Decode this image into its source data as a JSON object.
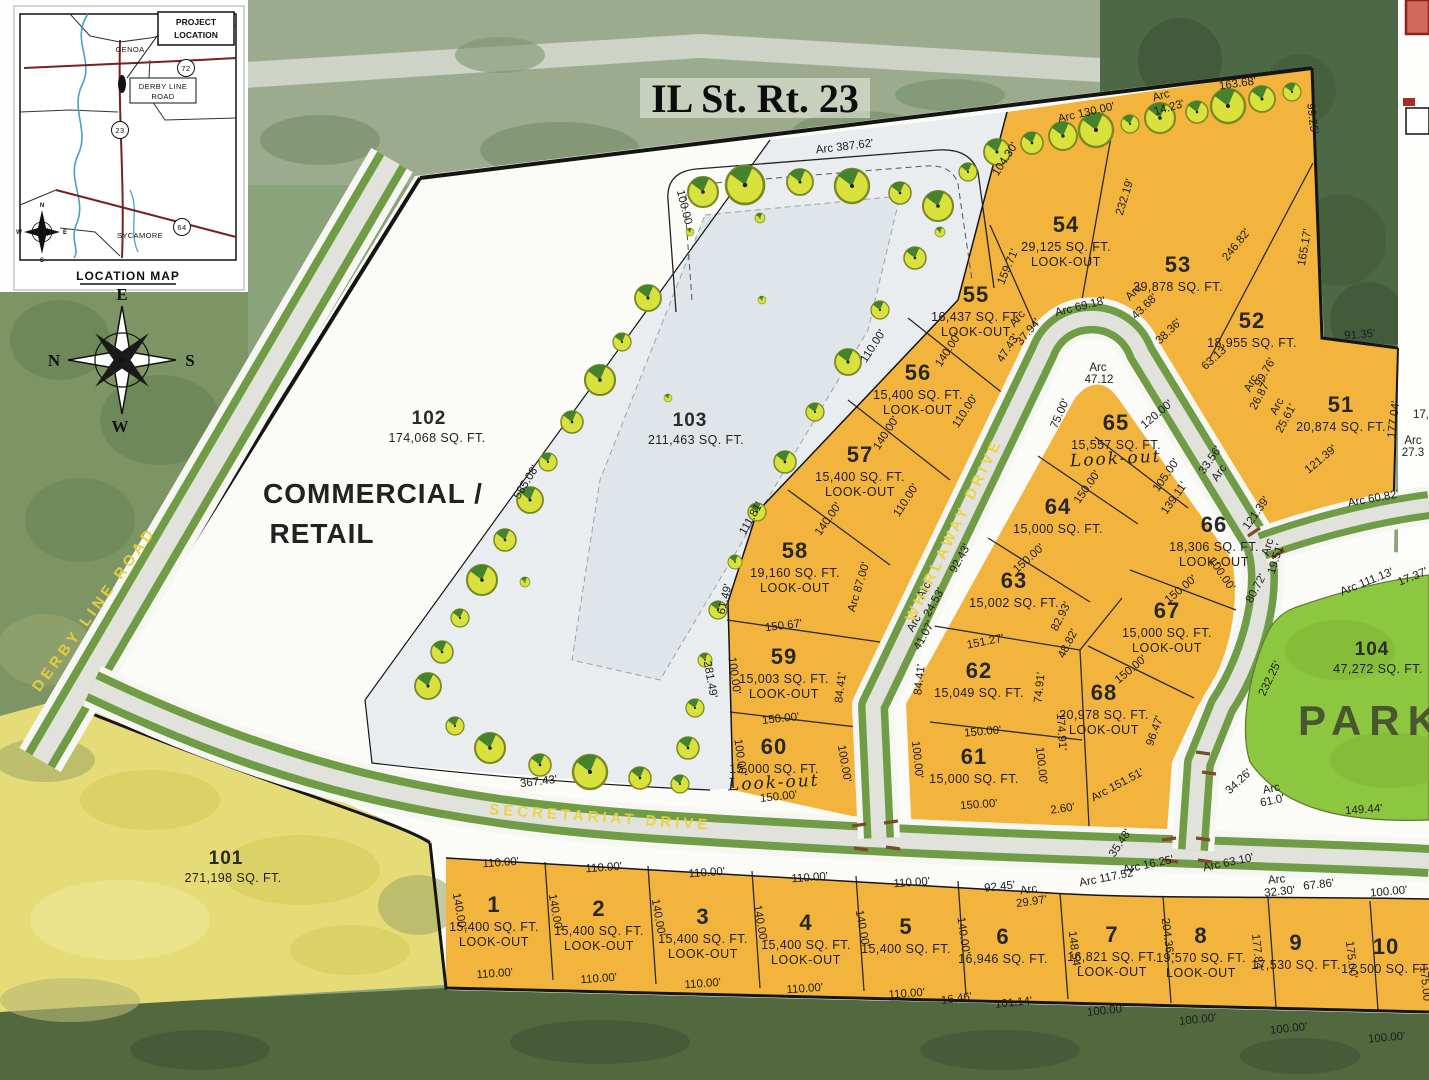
{
  "title": "IL St. Rt. 23",
  "location_map": {
    "caption": "LOCATION MAP",
    "project_location_line1": "PROJECT",
    "project_location_line2": "LOCATION",
    "town_north": "GENOA",
    "town_south": "SYCAMORE",
    "road_box_line1": "DERBY LINE",
    "road_box_line2": "ROAD",
    "route_72": "72",
    "route_23": "23",
    "route_64": "64",
    "compass": {
      "n": "N",
      "e": "E",
      "s": "S",
      "w": "W"
    }
  },
  "compass_rose": {
    "n": "N",
    "e": "E",
    "s": "S",
    "w": "W"
  },
  "roads": {
    "derby_line": "DERBY LINE ROAD",
    "secretariat": "SECRETARIAT DRIVE",
    "whirlaway": "WHIRLAWAY DRIVE"
  },
  "areas": {
    "commercial": {
      "num": "102",
      "sqft": "174,068 SQ. FT.",
      "line1": "COMMERCIAL /",
      "line2": "RETAIL"
    },
    "outlot103": {
      "num": "103",
      "sqft": "211,463 SQ. FT."
    },
    "outlot101": {
      "num": "101",
      "sqft": "271,198 SQ. FT."
    },
    "park": {
      "num": "104",
      "sqft": "47,272 SQ. FT.",
      "label": "PARK"
    }
  },
  "colors": {
    "lot_orange": "#F3B43E",
    "park_green": "#8DC63F",
    "field_yellow": "#E6DC77",
    "road_verge": "#6F9C45",
    "road_pavement": "#E2E2DC",
    "street_label_yellow": "#E9D33C"
  },
  "lots": [
    {
      "n": "54",
      "s": "29,125 SQ. FT.",
      "lo": "LOOK-OUT",
      "x": 1066,
      "y": 232
    },
    {
      "n": "53",
      "s": "39,878 SQ. FT.",
      "x": 1178,
      "y": 272
    },
    {
      "n": "52",
      "s": "18,955 SQ. FT.",
      "x": 1252,
      "y": 328
    },
    {
      "n": "55",
      "s": "16,437 SQ. FT.",
      "lo": "LOOK-OUT",
      "x": 976,
      "y": 302
    },
    {
      "n": "51",
      "s": "20,874 SQ. FT.",
      "x": 1341,
      "y": 412
    },
    {
      "n": "56",
      "s": "15,400 SQ. FT.",
      "lo": "LOOK-OUT",
      "x": 918,
      "y": 380
    },
    {
      "n": "57",
      "s": "15,400 SQ. FT.",
      "lo": "LOOK-OUT",
      "x": 860,
      "y": 462
    },
    {
      "n": "65",
      "s": "15,557 SQ. FT.",
      "lo": "Look-out",
      "hand": true,
      "x": 1116,
      "y": 430
    },
    {
      "n": "64",
      "s": "15,000 SQ. FT.",
      "x": 1058,
      "y": 514
    },
    {
      "n": "66",
      "s": "18,306 SQ. FT.",
      "lo": "LOOK-OUT",
      "x": 1214,
      "y": 532
    },
    {
      "n": "58",
      "s": "19,160 SQ. FT.",
      "lo": "LOOK-OUT",
      "x": 795,
      "y": 558
    },
    {
      "n": "63",
      "s": "15,002 SQ. FT.",
      "x": 1014,
      "y": 588
    },
    {
      "n": "67",
      "s": "15,000 SQ. FT.",
      "lo": "LOOK-OUT",
      "x": 1167,
      "y": 618
    },
    {
      "n": "59",
      "s": "15,003 SQ. FT.",
      "lo": "LOOK-OUT",
      "x": 784,
      "y": 664
    },
    {
      "n": "62",
      "s": "15,049 SQ. FT.",
      "x": 979,
      "y": 678
    },
    {
      "n": "68",
      "s": "20,978 SQ. FT.",
      "lo": "LOOK-OUT",
      "x": 1104,
      "y": 700
    },
    {
      "n": "60",
      "s": "15,000 SQ. FT.",
      "lo": "Look-out",
      "hand": true,
      "x": 774,
      "y": 754
    },
    {
      "n": "61",
      "s": "15,000 SQ. FT.",
      "x": 974,
      "y": 764
    },
    {
      "n": "1",
      "s": "15,400 SQ. FT.",
      "lo": "LOOK-OUT",
      "x": 494,
      "y": 912
    },
    {
      "n": "2",
      "s": "15,400 SQ. FT.",
      "lo": "LOOK-OUT",
      "x": 599,
      "y": 916
    },
    {
      "n": "3",
      "s": "15,400 SQ. FT.",
      "lo": "LOOK-OUT",
      "x": 703,
      "y": 924
    },
    {
      "n": "4",
      "s": "15,400 SQ. FT.",
      "lo": "LOOK-OUT",
      "x": 806,
      "y": 930
    },
    {
      "n": "5",
      "s": "15,400 SQ. FT.",
      "x": 906,
      "y": 934
    },
    {
      "n": "6",
      "s": "16,946 SQ. FT.",
      "x": 1003,
      "y": 944
    },
    {
      "n": "7",
      "s": "16,821 SQ. FT.",
      "lo": "LOOK-OUT",
      "x": 1112,
      "y": 942
    },
    {
      "n": "8",
      "s": "19,570 SQ. FT.",
      "lo": "LOOK-OUT",
      "x": 1201,
      "y": 943
    },
    {
      "n": "9",
      "s": "17,530 SQ. FT.",
      "x": 1296,
      "y": 950
    },
    {
      "n": "10",
      "s": "17,500 SQ. FT.",
      "x": 1386,
      "y": 954
    }
  ],
  "dimensions": [
    [
      "Arc 387.62'",
      845,
      150,
      -7
    ],
    [
      "100.00",
      681,
      208,
      76
    ],
    [
      "Arc 130.00'",
      1087,
      116,
      -13
    ],
    [
      "163.68'",
      1238,
      87,
      -8
    ],
    [
      "Arc",
      1162,
      99,
      -16
    ],
    [
      "14.23'",
      1170,
      111,
      -16
    ],
    [
      "99.25'",
      1309,
      119,
      83
    ],
    [
      "104.30'",
      1008,
      161,
      -57
    ],
    [
      "232.19'",
      1128,
      198,
      -73
    ],
    [
      "246.82'",
      1239,
      247,
      -51
    ],
    [
      "165.17'",
      1308,
      248,
      -80
    ],
    [
      "159.71'",
      1011,
      268,
      -67
    ],
    [
      "91.35'",
      1360,
      338,
      -4
    ],
    [
      "Arc 69.18'",
      1081,
      310,
      -14
    ],
    [
      "Arc",
      1136,
      295,
      -44
    ],
    [
      "43.68'",
      1147,
      309,
      -44
    ],
    [
      "38.36'",
      1171,
      334,
      -44
    ],
    [
      "Arc",
      1020,
      321,
      -50
    ],
    [
      "37.94'",
      1031,
      334,
      -50
    ],
    [
      "47.43'",
      1011,
      350,
      -57
    ],
    [
      "63.13'",
      1217,
      360,
      -42
    ],
    [
      "99.76'",
      1268,
      374,
      -60
    ],
    [
      "177.04'",
      1397,
      420,
      -83
    ],
    [
      "121.39'",
      1323,
      462,
      -40
    ],
    [
      "Arc 60.82'",
      1374,
      502,
      -10
    ],
    [
      "17,",
      1421,
      418,
      0
    ],
    [
      "Arc",
      1413,
      444,
      0
    ],
    [
      "27.3",
      1413,
      456,
      0
    ],
    [
      "Arc",
      1098,
      371,
      0
    ],
    [
      "47.12",
      1099,
      383,
      0
    ],
    [
      "120.00'",
      1159,
      417,
      -40
    ],
    [
      "75.00'",
      1063,
      415,
      -66
    ],
    [
      "150.00'",
      1090,
      489,
      -55
    ],
    [
      "105.00'",
      1169,
      477,
      -55
    ],
    [
      "139.11'",
      1177,
      500,
      -55
    ],
    [
      "33.56'",
      1213,
      462,
      -55
    ],
    [
      "Arc",
      1222,
      475,
      -55
    ],
    [
      "121.39'",
      1259,
      515,
      -55
    ],
    [
      "Arc",
      1254,
      385,
      -62
    ],
    [
      "26.87'",
      1263,
      397,
      -62
    ],
    [
      "Arc",
      1280,
      408,
      -62
    ],
    [
      "25.61'",
      1289,
      420,
      -62
    ],
    [
      "Arc",
      1271,
      548,
      -72
    ],
    [
      "19.51'",
      1279,
      560,
      -72
    ],
    [
      "80.72'",
      1259,
      590,
      -62
    ],
    [
      "96.47'",
      1158,
      732,
      -70
    ],
    [
      "150.00'",
      1183,
      592,
      -40
    ],
    [
      "100.00'",
      1219,
      576,
      55
    ],
    [
      "150.00'",
      1133,
      672,
      -40
    ],
    [
      "110.00'",
      876,
      348,
      -57
    ],
    [
      "140.00'",
      951,
      352,
      -57
    ],
    [
      "110.00'",
      968,
      413,
      -57
    ],
    [
      "140.00'",
      889,
      435,
      -57
    ],
    [
      "110.00'",
      909,
      502,
      -57
    ],
    [
      "140.00'",
      831,
      521,
      -55
    ],
    [
      "Arc 87.00'",
      862,
      588,
      -73
    ],
    [
      "111.81'",
      754,
      520,
      -60
    ],
    [
      "61.49'",
      728,
      600,
      -76
    ],
    [
      "150.67'",
      784,
      629,
      -7
    ],
    [
      "84.41'",
      844,
      688,
      -83
    ],
    [
      "100.00'",
      731,
      676,
      82
    ],
    [
      "150.00'",
      781,
      722,
      -6
    ],
    [
      "100.00'",
      737,
      758,
      82
    ],
    [
      "100.00'",
      841,
      764,
      80
    ],
    [
      "150.00'",
      779,
      800,
      -6
    ],
    [
      "281.49'",
      707,
      680,
      80
    ],
    [
      "585.08'",
      529,
      484,
      -58
    ],
    [
      "367.43'",
      539,
      785,
      -7
    ],
    [
      "150.00'",
      1031,
      561,
      -42
    ],
    [
      "151.27'",
      986,
      645,
      -11
    ],
    [
      "92.43'",
      963,
      560,
      -61
    ],
    [
      "Arc",
      927,
      592,
      -61
    ],
    [
      "24.53'",
      937,
      604,
      -61
    ],
    [
      "Arc",
      917,
      625,
      -61
    ],
    [
      "41.07'",
      927,
      637,
      -61
    ],
    [
      "84.41'",
      923,
      680,
      -83
    ],
    [
      "82.93'",
      1064,
      618,
      -63
    ],
    [
      "48.82'",
      1071,
      645,
      -63
    ],
    [
      "74.91'",
      1043,
      688,
      -84
    ],
    [
      "174.91'",
      1058,
      732,
      86
    ],
    [
      "150.00'",
      983,
      735,
      -5
    ],
    [
      "100.00'",
      914,
      760,
      84
    ],
    [
      "100.00'",
      1038,
      766,
      84
    ],
    [
      "150.00'",
      979,
      808,
      -4
    ],
    [
      "Arc 151.51'",
      1119,
      788,
      -28
    ],
    [
      "2.60'",
      1063,
      812,
      -8
    ],
    [
      "35.48'",
      1123,
      845,
      -56
    ],
    [
      "Arc 16.25'",
      1149,
      868,
      -12
    ],
    [
      "Arc 63.10'",
      1229,
      866,
      -12
    ],
    [
      "Arc 117.52'",
      1108,
      881,
      -11
    ],
    [
      "232.25'",
      1273,
      680,
      -64
    ],
    [
      "34.26'",
      1241,
      784,
      -43
    ],
    [
      "Arc",
      1272,
      792,
      -12
    ],
    [
      "61.0'",
      1273,
      804,
      -12
    ],
    [
      "149.44'",
      1364,
      813,
      -4
    ],
    [
      "Arc 111.13'",
      1368,
      585,
      -22
    ],
    [
      "17.37'",
      1414,
      580,
      -22
    ],
    [
      "110.00'",
      501,
      866,
      -4
    ],
    [
      "110.00'",
      604,
      871,
      -4
    ],
    [
      "110.00'",
      707,
      876,
      -4
    ],
    [
      "110.00'",
      810,
      881,
      -4
    ],
    [
      "110.00'",
      912,
      886,
      -4
    ],
    [
      "110.00'",
      495,
      977,
      -4
    ],
    [
      "110.00'",
      599,
      982,
      -4
    ],
    [
      "110.00'",
      703,
      987,
      -4
    ],
    [
      "110.00'",
      805,
      992,
      -4
    ],
    [
      "110.00'",
      907,
      997,
      -4
    ],
    [
      "140.00'",
      456,
      912,
      80
    ],
    [
      "140.00'",
      552,
      913,
      80
    ],
    [
      "140.00'",
      655,
      918,
      80
    ],
    [
      "140.00'",
      757,
      924,
      80
    ],
    [
      "140.00'",
      859,
      929,
      80
    ],
    [
      "140.00'",
      960,
      936,
      82
    ],
    [
      "92.45'",
      1000,
      890,
      -6
    ],
    [
      "Arc",
      1029,
      893,
      -8
    ],
    [
      "29.97'",
      1032,
      905,
      -8
    ],
    [
      "16.46'",
      957,
      1002,
      -8
    ],
    [
      "101.14'",
      1014,
      1006,
      -6
    ],
    [
      "148.54'",
      1071,
      950,
      83
    ],
    [
      "100.00'",
      1106,
      1014,
      -6
    ],
    [
      "204.36'",
      1164,
      937,
      83
    ],
    [
      "100.00'",
      1198,
      1023,
      -6
    ],
    [
      "177.84'",
      1254,
      953,
      84
    ],
    [
      "Arc",
      1277,
      883,
      -6
    ],
    [
      "32.30'",
      1280,
      895,
      -6
    ],
    [
      "67.86'",
      1319,
      888,
      -6
    ],
    [
      "100.00'",
      1289,
      1032,
      -6
    ],
    [
      "175.00'",
      1348,
      960,
      84
    ],
    [
      "100.00'",
      1389,
      895,
      -5
    ],
    [
      "100.00'",
      1387,
      1041,
      -5
    ],
    [
      "175.00'",
      1422,
      985,
      84
    ]
  ]
}
